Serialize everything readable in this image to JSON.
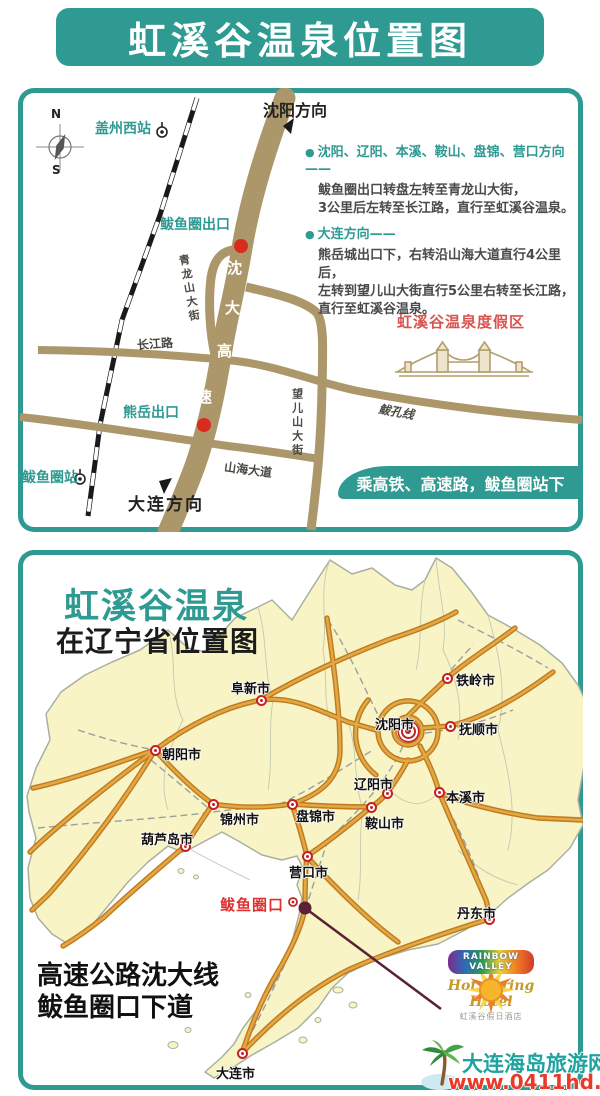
{
  "banner_title": "虹溪谷温泉位置图",
  "colors": {
    "teal": "#2E9A92",
    "road_tan": "#AB9769",
    "land_yellow": "#F8F4C5",
    "highway_orange": "#D89638",
    "resort_red": "#D9534F",
    "marker_red": "#C42222",
    "pointer_plum": "#5A2335",
    "watermark_teal": "#1FA3A0",
    "watermark_red": "#E8392A"
  },
  "top_map": {
    "compass": {
      "n": "N",
      "s": "S"
    },
    "shenyang_direction": "沈阳方向",
    "dalian_direction": "大连方向",
    "gaizhou_west_station": "盖州西站",
    "bayuquan_station": "鲅鱼圈站",
    "bayuquan_exit": "鲅鱼圈出口",
    "xiongyue_exit": "熊岳出口",
    "qinglongshan_street": "青龙山大街",
    "changjiang_road": "长江路",
    "shanhai_avenue": "山海大道",
    "wangershan_street": "望儿山大街",
    "bakong_line": "鲅孔线",
    "expressway_name": [
      "沈",
      "大",
      "高",
      "速"
    ],
    "resort_label": "虹溪谷温泉度假区",
    "directions": [
      {
        "heading": "沈阳、辽阳、本溪、鞍山、盘锦、营口方向——",
        "lines": [
          "鲅鱼圈出口转盘左转至青龙山大街，",
          "3公里后左转至长江路，直行至虹溪谷温泉。"
        ]
      },
      {
        "heading": "大连方向——",
        "lines": [
          "熊岳城出口下，右转沿山海大道直行4公里后，",
          "左转到望儿山大街直行5公里右转至长江路，",
          "直行至虹溪谷温泉。"
        ]
      }
    ],
    "ride_banner": "乘高铁、高速路，鲅鱼圈站下"
  },
  "province_map": {
    "title": "虹溪谷温泉",
    "subtitle": "在辽宁省位置图",
    "note_lines": [
      "高速公路沈大线",
      "鲅鱼圈口下道"
    ],
    "bayuquan_exit_label": "鲅鱼圈口",
    "cities": [
      {
        "name": "朝阳市",
        "x": 137,
        "y": 200,
        "lx": 144,
        "ly": 194
      },
      {
        "name": "阜新市",
        "x": 243,
        "y": 150,
        "lx": 213,
        "ly": 128
      },
      {
        "name": "铁岭市",
        "x": 429,
        "y": 128,
        "lx": 438,
        "ly": 120
      },
      {
        "name": "沈阳市",
        "x": 390,
        "y": 181,
        "lx": 357,
        "ly": 164,
        "type": "capital"
      },
      {
        "name": "抚顺市",
        "x": 432,
        "y": 176,
        "lx": 441,
        "ly": 169
      },
      {
        "name": "辽阳市",
        "x": 369,
        "y": 243,
        "lx": 336,
        "ly": 224
      },
      {
        "name": "本溪市",
        "x": 421,
        "y": 242,
        "lx": 428,
        "ly": 237
      },
      {
        "name": "鞍山市",
        "x": 353,
        "y": 257,
        "lx": 347,
        "ly": 263
      },
      {
        "name": "盘锦市",
        "x": 274,
        "y": 254,
        "lx": 278,
        "ly": 256
      },
      {
        "name": "营口市",
        "x": 289,
        "y": 306,
        "lx": 271,
        "ly": 312
      },
      {
        "name": "锦州市",
        "x": 195,
        "y": 254,
        "lx": 202,
        "ly": 259
      },
      {
        "name": "葫芦岛市",
        "x": 167,
        "y": 296,
        "lx": 123,
        "ly": 279
      },
      {
        "name": "丹东市",
        "x": 471,
        "y": 369,
        "lx": 439,
        "ly": 353
      },
      {
        "name": "大连市",
        "x": 224,
        "y": 503,
        "lx": 198,
        "ly": 513
      }
    ],
    "logo": {
      "name_top": "RAINBOW",
      "name_bottom": "VALLEY",
      "script": "Hot Spring Hotel",
      "sub": "虹溪谷假日酒店"
    },
    "watermark": {
      "site": "大连海岛旅游网",
      "url": "www.0411hd.com"
    }
  }
}
